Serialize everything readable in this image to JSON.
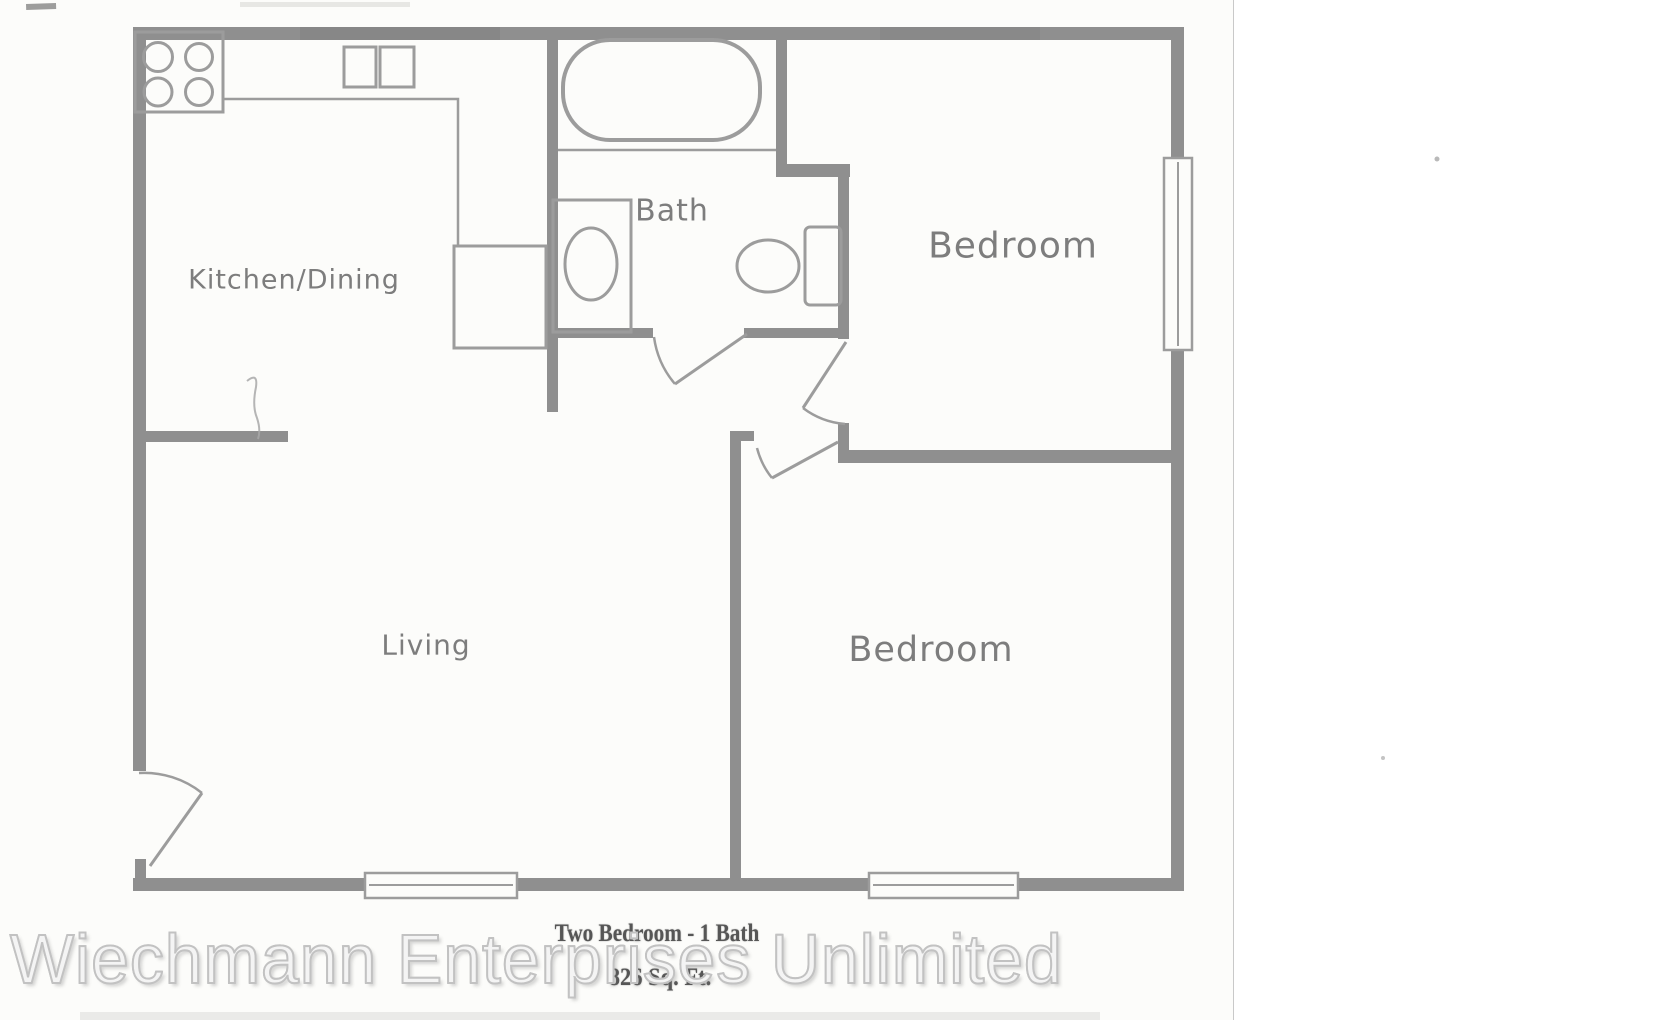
{
  "floor_plan": {
    "rooms": [
      {
        "id": "kitchen-dining",
        "label": "Kitchen/Dining"
      },
      {
        "id": "bath",
        "label": "Bath"
      },
      {
        "id": "bedroom-top",
        "label": "Bedroom"
      },
      {
        "id": "living",
        "label": "Living"
      },
      {
        "id": "bedroom-bottom",
        "label": "Bedroom"
      }
    ],
    "caption": {
      "title": "Two Bedroom - 1 Bath",
      "area": "826 Sq. Ft."
    },
    "fixtures": {
      "kitchen": [
        "stove-4-burner",
        "counter",
        "double-sink",
        "refrigerator"
      ],
      "bath": [
        "bathtub",
        "vanity-sink",
        "toilet"
      ],
      "window_count": 3,
      "door_swing_count": 4
    },
    "colors": {
      "wall": "#8f8f8f",
      "fixture_line": "#9c9c9c",
      "label_text": "#7d7d7d",
      "caption_text": "#565656",
      "scan_background": "#fcfcfa"
    }
  },
  "watermark": {
    "text": "Wiechmann Enterprises Unlimited",
    "fill": "rgba(255,255,255,0.8)",
    "outline": "#c2c2c2"
  }
}
